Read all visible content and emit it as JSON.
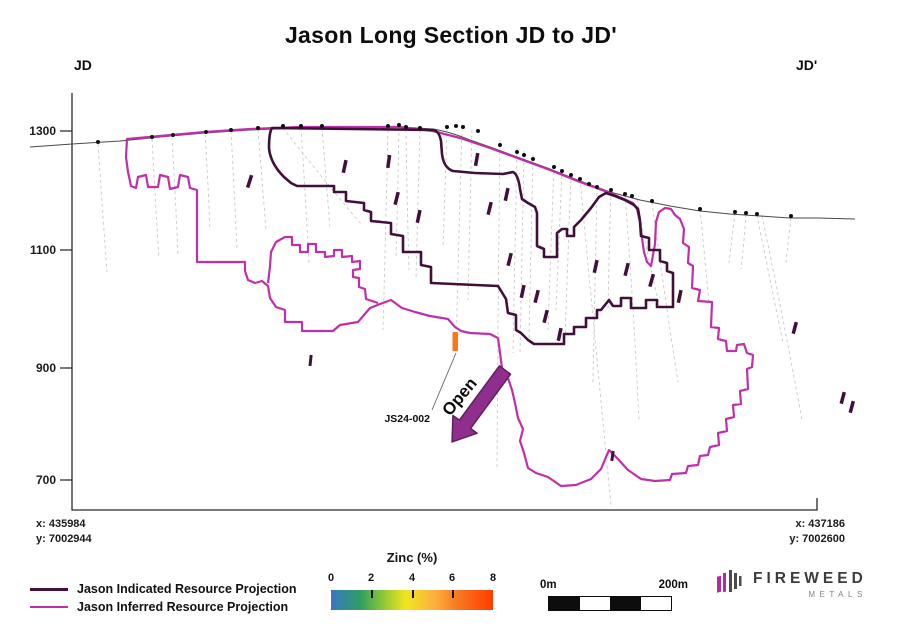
{
  "title": "Jason Long Section JD to JD'",
  "section_ends": {
    "left": "JD",
    "right": "JD'"
  },
  "axis": {
    "y_ticks": [
      "1300",
      "1100",
      "900",
      "700"
    ]
  },
  "corners": {
    "left": {
      "x": "x: 435984",
      "y": "y: 7002944"
    },
    "right": {
      "x": "x: 437186",
      "y": "y: 7002600"
    }
  },
  "annotations": {
    "open_label": "Open",
    "drillhole_label": "JS24-002"
  },
  "legend": {
    "items": [
      {
        "label": "Jason Indicated Resource Projection",
        "color": "#401038"
      },
      {
        "label": "Jason Inferred Resource Projection",
        "color": "#c12fa8"
      }
    ]
  },
  "colorbar": {
    "title": "Zinc (%)",
    "ticks": [
      "0",
      "2",
      "4",
      "6",
      "8"
    ]
  },
  "scalebar": {
    "left": "0m",
    "right": "200m"
  },
  "logo": {
    "name": "FIREWEED",
    "sub": "METALS"
  },
  "colors": {
    "indicated": "#401038",
    "inferred": "#c12fa8",
    "open_arrow": "#8f2e8d",
    "highlight_intercept": "#ff7418",
    "topography": "#4a4a4a",
    "drill_trace": "#c6c6c6"
  }
}
